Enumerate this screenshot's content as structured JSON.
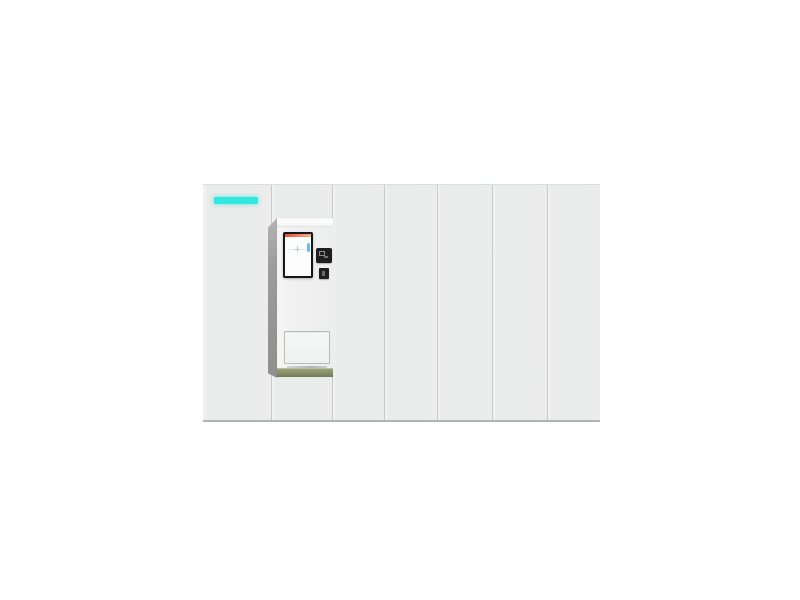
{
  "scene": {
    "description": "3D product render of a white smart parcel locker bank with seven door columns, a cyan status LED strip on the left door, and a built-in self-service kiosk terminal on the second column, on a plain white background",
    "background": "plain white"
  },
  "locker": {
    "panel_count": 7,
    "led_label": "status-led-strip",
    "doors": [
      {
        "label": "locker-door-1",
        "has_led": true
      },
      {
        "label": "locker-door-2",
        "has_kiosk": true
      },
      {
        "label": "locker-door-3"
      },
      {
        "label": "locker-door-4"
      },
      {
        "label": "locker-door-5"
      },
      {
        "label": "locker-door-6"
      },
      {
        "label": "locker-door-7"
      }
    ]
  },
  "kiosk": {
    "label": "self-service kiosk terminal",
    "parts": {
      "top_band": "glossy white top band",
      "screen": "portrait touchscreen with orange header bar and blue accent",
      "scanner": "qr-code-scanner module",
      "card_reader": "card-reader slot",
      "drawer": "parcel pickup drawer",
      "base": "olive-green kiosk base plinth",
      "side": "dark side panel shadow wedge"
    }
  },
  "colors": {
    "page_bg": "#ffffff",
    "panel": "#eaebeb",
    "panel_highlight": "#f2f3f3",
    "divider": "#c7cac9",
    "bank_top_line": "#dcdfde",
    "bank_bottom_line": "#aeb6b5",
    "led_strip": "#2fe8e0",
    "kiosk_body": "#f0f1f0",
    "kiosk_top_band": "#fdfdfd",
    "kiosk_side_shadow": "#9c9c9a",
    "kiosk_base": "#868c66",
    "screen_bezel": "#161616",
    "screen_bg": "#fdfdfd",
    "screen_header": "#e2512f",
    "screen_header_light": "#f6ac92",
    "screen_accent": "#6fb7f4",
    "module_dark": "#1e1e1e",
    "module_glyph": "#8d8d8d",
    "drawer_border": "#b7bbba",
    "drawer_face": "#f5f6f5"
  }
}
